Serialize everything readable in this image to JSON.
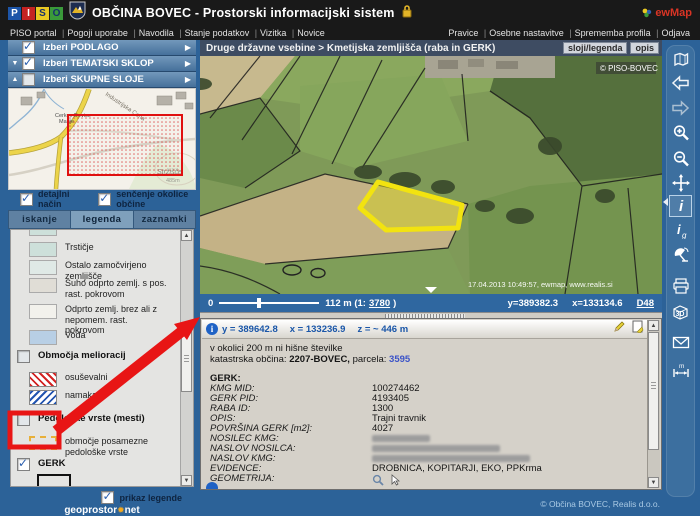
{
  "header": {
    "logo_letters": [
      "P",
      "I",
      "S",
      "O"
    ],
    "title": "OBČINA BOVEC - Prostorski informacijski sistem",
    "brand": "ewMap",
    "menu_left": [
      "PISO portal",
      "Pogoji uporabe",
      "Navodila",
      "Stanje podatkov",
      "Vizitka",
      "Novice"
    ],
    "menu_right": [
      "Pravice",
      "Osebne nastavitve",
      "Sprememba profila",
      "Odjava"
    ]
  },
  "sidebar": {
    "accordions": [
      {
        "label": "Izberi PODLAGO"
      },
      {
        "label": "Izberi TEMATSKI SKLOP"
      },
      {
        "label": "Izberi SKUPNE SLOJE"
      }
    ],
    "overview": {
      "church_label": "Cerkev Device",
      "church_label2": "Marije",
      "road_label": "Industrijska Cona",
      "hill_label": "Stržišče",
      "hill_elev": "485m"
    },
    "options": [
      {
        "label": "detajlni način"
      },
      {
        "label": "senčenje okolice občine"
      }
    ],
    "tabs": [
      {
        "label": "iskanje"
      },
      {
        "label": "legenda"
      },
      {
        "label": "zaznamki"
      }
    ],
    "legend": {
      "items": [
        {
          "label": "Trstičje"
        },
        {
          "label": "Ostalo zamočvirjeno zemljišče"
        },
        {
          "label": "Suho odprto zemlj. s pos. rast. pokrovom"
        },
        {
          "label": "Odprto zemlj. brez ali z nepomem. rast. pokrovom"
        },
        {
          "label": "Voda"
        },
        {
          "label": "Območja melioracij"
        },
        {
          "label": "osuševalni"
        },
        {
          "label": "namakalni"
        },
        {
          "label": "Pedološke vrste (mesti)"
        },
        {
          "label": "območje posamezne pedološke vrste"
        },
        {
          "label": "GERK"
        },
        {
          "label": "KMG"
        }
      ],
      "show_legend_label": "prikaz legende"
    },
    "footer": {
      "logo_left": "geoprostor",
      "logo_right": "net"
    }
  },
  "map": {
    "breadcrumb": "Druge državne vsebine > Kmetijska zemljišča (raba in GERK)",
    "buttons": [
      {
        "label": "sloji/legenda"
      },
      {
        "label": "opis"
      }
    ],
    "copyright": "© PISO-BOVEC",
    "watermark": "17.04.2013 10:49:57, ewmap, www.realis.si",
    "scalebar": {
      "zero": "0",
      "scale_prefix": "112 m (1:",
      "scale_value": "3780",
      "scale_suffix": ")",
      "coord_y": "y=389382.3",
      "coord_x": "x=133134.6",
      "datum": "D48"
    }
  },
  "info": {
    "coord_y": "y = 389642.8",
    "coord_x": "x = 133236.9",
    "coord_z": "z = ~ 446 m",
    "line1": "v okolici 200 m ni hišne številke",
    "cadastral_prefix": "katastrska občina:",
    "cadastral_value": "2207-BOVEC,",
    "parcel_label": "parcela:",
    "parcel_value": "3595",
    "section_title": "GERK:",
    "rows": [
      {
        "label": "KMG MID:",
        "value": "100274462"
      },
      {
        "label": "GERK PID:",
        "value": "4193405"
      },
      {
        "label": "RABA ID:",
        "value": "1300"
      },
      {
        "label": "OPIS:",
        "value": "Trajni travnik"
      },
      {
        "label": "POVRŠINA GERK [m2]:",
        "value": "4027"
      },
      {
        "label": "NOSILEC KMG:",
        "value": ""
      },
      {
        "label": "NASLOV NOSILCA:",
        "value": ""
      },
      {
        "label": "NASLOV KMG:",
        "value": ""
      },
      {
        "label": "EVIDENCE:",
        "value": "DROBNICA, KOPITARJI, EKO, PPKrma"
      },
      {
        "label": "GEOMETRIJA:",
        "value": ""
      }
    ],
    "copyright": "© Občina BOVEC, Realis d.o.o."
  },
  "toolbar": {
    "info_label": "i",
    "infog_label": "i",
    "infog_sub": "g",
    "threed_label": "3D",
    "measure_label": "m"
  },
  "colors": {
    "accent_blue": "#2c6298",
    "panel_gray": "#d5d1c9",
    "highlight_yellow": "#f2e310",
    "annotation_red": "#e81515",
    "link_blue": "#3a52c8"
  }
}
